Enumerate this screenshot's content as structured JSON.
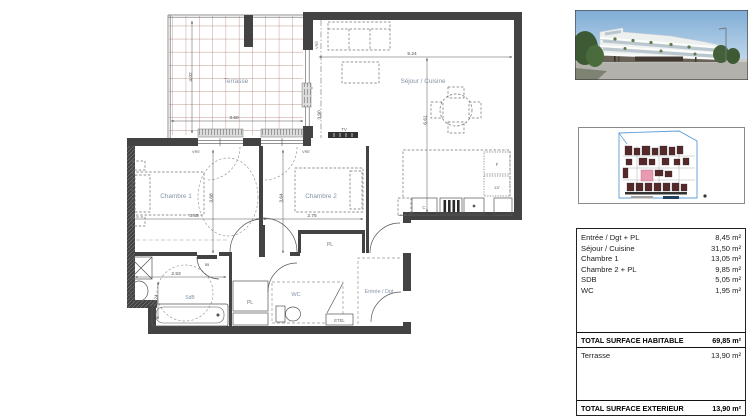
{
  "plan": {
    "labels": {
      "terrasse": "Terrasse",
      "sejour": "Séjour / Cuisine",
      "chambre1": "Chambre 1",
      "chambre2": "Chambre 2",
      "sdb": "SdB",
      "wc": "WC",
      "entree": "Entrée / Dgt",
      "pl_hall": "PL",
      "pl_chambre2": "PL"
    },
    "equipment": {
      "tv": "TV",
      "fridge": "F",
      "dishwasher": "LV",
      "boiler": "C",
      "etel": "ETEL",
      "vre_window1": "VRE",
      "vre_window2": "VRE",
      "vre_bay": "VRE"
    },
    "dims": {
      "terrasse_h": "4.02",
      "terrasse_w": "3.50",
      "sejour_w": "5.24",
      "sejour_h": "6.61",
      "bay_h": "3.90",
      "chambre1_w": "3.55",
      "chambre1_h": "3.68",
      "chambre2_w": "2.75",
      "chambre2_h": "3.64",
      "sdb_w": "2.53",
      "sdb_h": "2.24",
      "sdb_door": "55"
    }
  },
  "sidebar": {
    "table": {
      "rows": [
        {
          "label": "Entrée / Dgt + PL",
          "value": "8,45 m²"
        },
        {
          "label": "Séjour / Cuisine",
          "value": "31,50 m²"
        },
        {
          "label": "Chambre 1",
          "value": "13,05 m²"
        },
        {
          "label": "Chambre 2 + PL",
          "value": "9,85 m²"
        },
        {
          "label": "SDB",
          "value": "5,05 m²"
        },
        {
          "label": "WC",
          "value": "1,95 m²"
        }
      ],
      "total_habitable": {
        "label": "TOTAL SURFACE HABITABLE",
        "value": "69,85 m²"
      },
      "terrasse": {
        "label": "Terrasse",
        "value": "13,90 m²"
      },
      "total_exterieur": {
        "label": "TOTAL SURFACE EXTERIEUR",
        "value": "13,90 m²"
      }
    }
  },
  "colors": {
    "wall": "#434343",
    "tile_line": "#a8766b",
    "room_label": "#8494a6",
    "dimension": "#4a4a4a",
    "site_boundary": "#5b9bd5",
    "site_building": "#55282a",
    "site_highlight": "#e89ab0",
    "sky": "#86b3d9"
  }
}
